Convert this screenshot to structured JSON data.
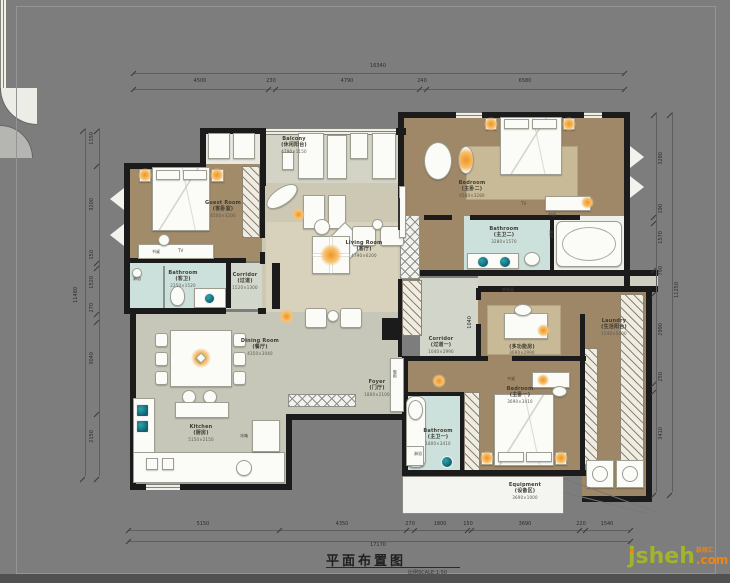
{
  "title": {
    "text": "平面布置图",
    "scale_note": "比例SCALE:1:50"
  },
  "watermark": {
    "brand": "jsheh",
    "tld": ".com",
    "tagline": "装修汇"
  },
  "dims": {
    "top": {
      "total": "16340",
      "segments": [
        "4500",
        "230",
        "4790",
        "240",
        "6580"
      ]
    },
    "bottom": {
      "total": "17170",
      "segments": [
        "5150",
        "4350",
        "270",
        "1800",
        "150",
        "3690",
        "220",
        "1540"
      ]
    },
    "left": {
      "total": "11480",
      "segments": [
        "1150",
        "3200",
        "150",
        "1520",
        "270",
        "3040",
        "2150"
      ]
    },
    "right": {
      "total": "11250",
      "segments": [
        "3280",
        "190",
        "1570",
        "790",
        "2990",
        "250",
        "3410"
      ]
    },
    "inner": {
      "corridor": "1040"
    }
  },
  "rooms": {
    "guest": {
      "en": "Guest Room",
      "zh": "(客卧室)",
      "size": "4500×3200"
    },
    "guest_bath": {
      "en": "Bathroom",
      "zh": "(客卫)",
      "size": "2250×1520"
    },
    "corridor": {
      "en": "Corridor",
      "zh": "(过道)",
      "size": "1520×1300"
    },
    "balcony": {
      "en": "Balcony",
      "zh": "(休闲阳台)",
      "size": "4790×1150"
    },
    "living": {
      "en": "Living Room",
      "zh": "(客厅)",
      "size": "4790×6200"
    },
    "bedroom2": {
      "en": "Bedroom",
      "zh": "(主卧二)",
      "size": "6580×3280"
    },
    "bath2": {
      "en": "Bathroom",
      "zh": "(主卫二)",
      "size": "3280×1570"
    },
    "corridor1": {
      "en": "Corridor",
      "zh": "(过道一)",
      "size": "1040×2990"
    },
    "multi": {
      "en": "",
      "zh": "(多功能房)",
      "size": "3690×2990"
    },
    "laundry": {
      "en": "Laundry",
      "zh": "(生活阳台)",
      "size": "1540×5000"
    },
    "bedroom1": {
      "en": "Bedroom",
      "zh": "(主卧一)",
      "size": "3690×3410"
    },
    "bath1": {
      "en": "Bathroom",
      "zh": "(主卫一)",
      "size": "1800×3410"
    },
    "dining": {
      "en": "Dining Room",
      "zh": "(餐厅)",
      "size": "4350×3040"
    },
    "kitchen": {
      "en": "Kitchen",
      "zh": "(厨房)",
      "size": "5150×2150"
    },
    "foyer": {
      "en": "Foyer",
      "zh": "(门厅)",
      "size": "1800×2100"
    },
    "equipment": {
      "en": "Equipment",
      "zh": "(设备区)",
      "size": "3690×1000"
    }
  },
  "annotations": {
    "tv": "TV",
    "desk": "书桌",
    "shower": "淋浴",
    "fridge": "冰箱",
    "shoe_cabinet": "鞋柜",
    "painting": "装饰画"
  },
  "colors": {
    "canvas": "#7d7d7d",
    "wall": "#1b1b1b",
    "bedroom_floor": "#9f8868",
    "living_floor": "#cdc8b4",
    "dining_floor": "#c6c7b8",
    "bath_floor": "#cde1dc",
    "accent_orange": "#ef9420",
    "sink_teal": "#0e6a78",
    "watermark_green": "#a3b42a",
    "watermark_orange": "#f08511"
  }
}
